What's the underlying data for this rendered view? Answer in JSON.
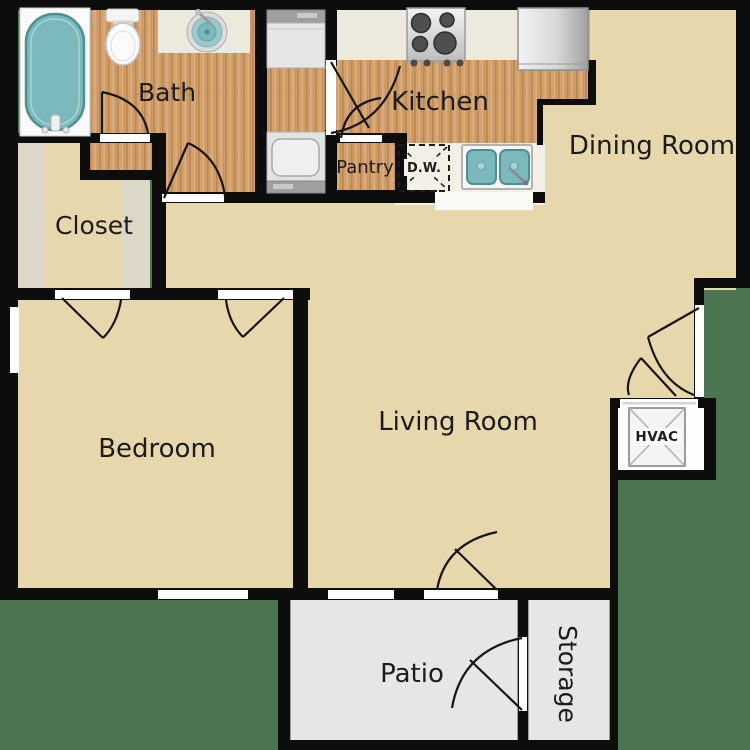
{
  "rooms": {
    "bath": "Bath",
    "closet": "Closet",
    "kitchen": "Kitchen",
    "dining": "Dining Room",
    "pantry": "Pantry",
    "living": "Living Room",
    "bedroom": "Bedroom",
    "patio": "Patio",
    "storage": "Storage"
  },
  "fixtures": {
    "dishwasher": "D.W.",
    "hvac": "HVAC"
  },
  "colors": {
    "background": "#4a7550",
    "wall": "#0d0d0d",
    "floor_main_beige": "#e6d7ad",
    "floor_wood": "#d2a06e",
    "floor_patio_gray": "#e6e6e6",
    "closet_shelf_gray": "#dcd7c9",
    "counter_cream": "#eceadd",
    "fixture_teal": "#7cb9bd"
  }
}
